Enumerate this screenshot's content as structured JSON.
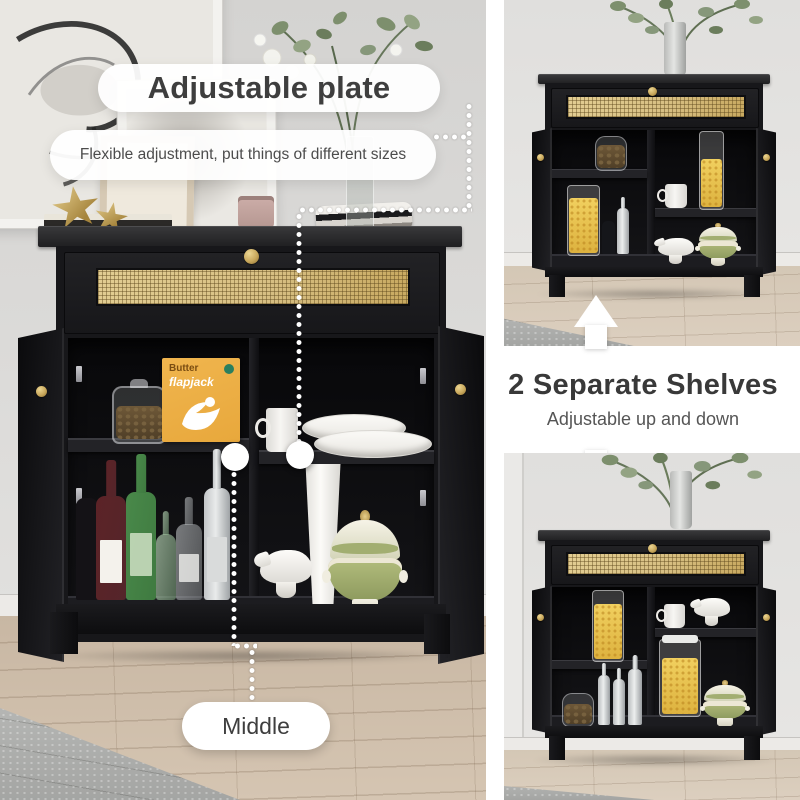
{
  "page": {
    "type": "product-feature-image",
    "product": "black rattan sideboard cabinet"
  },
  "callouts": {
    "adjustable_plate": {
      "title": "Adjustable plate",
      "subtitle": "Flexible adjustment, put things of different sizes",
      "marker_label": "Middle"
    },
    "separate_shelves": {
      "title": "2 Separate Shelves",
      "subtitle": "Adjustable up and down"
    }
  },
  "scene_props": {
    "cereal_box": {
      "line1": "Butter",
      "line2": "flapjack"
    }
  },
  "icons": {
    "leader_line": "white-dotted-leader",
    "shelf_marker": "white-circle-marker",
    "adjust_arrow_up": "white-block-arrow-up",
    "adjust_arrow_down": "white-block-arrow-down"
  },
  "colors": {
    "wall": "#dbdad8",
    "floor_wood": "#cbbaa6",
    "rug": "#b3b4b2",
    "cabinet_black": "#17171a",
    "rattan": "#d7bf83",
    "brass_knob": "#c9a85c",
    "text_dark": "#3e3e3e",
    "pill_white": "#ffffff",
    "cereal_yellow": "#ddb23f",
    "tureen_green": "#a2ae71",
    "box_orange": "#e8a83c",
    "bottle_green": "#3f7a40",
    "wine_maroon": "#54252a"
  }
}
